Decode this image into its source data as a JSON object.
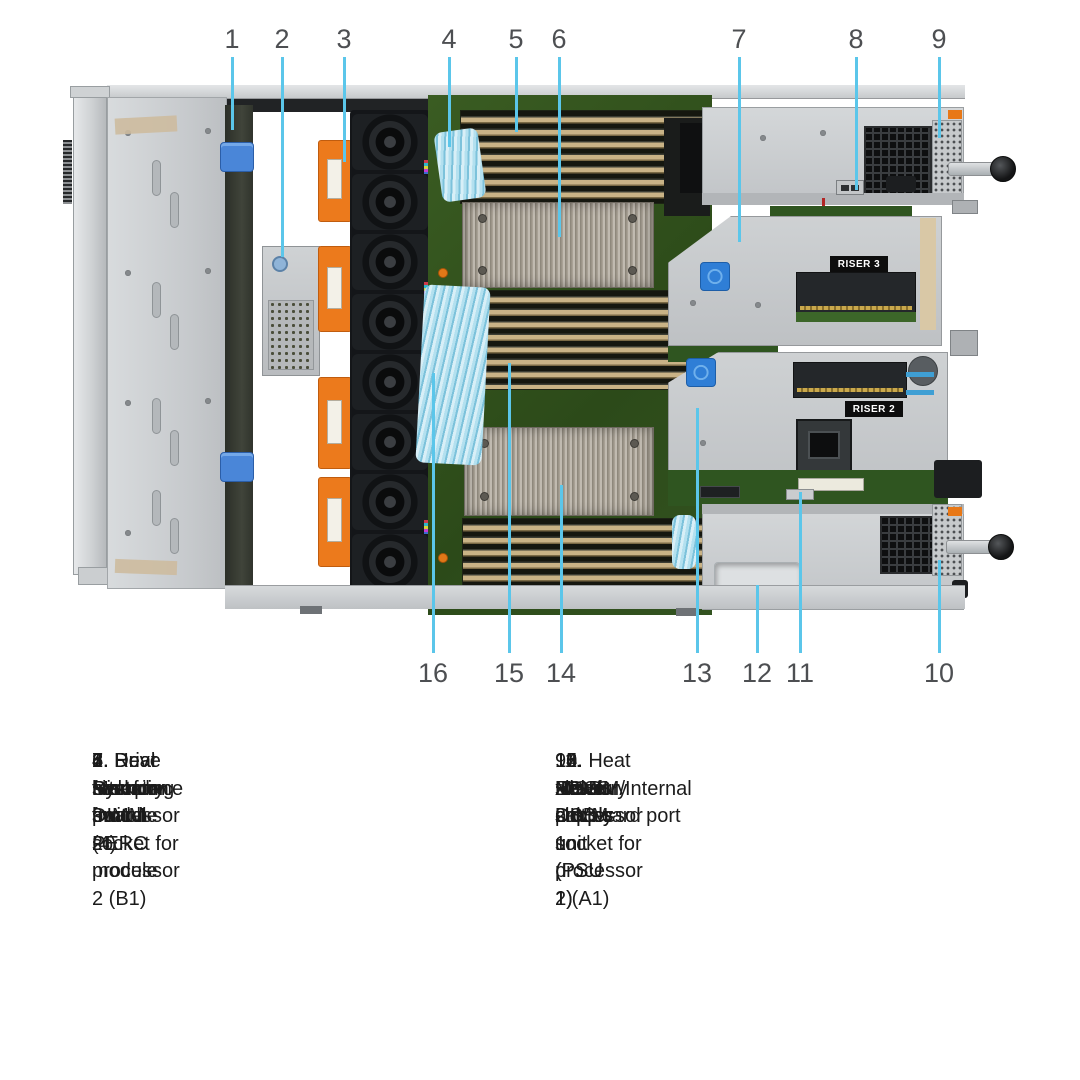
{
  "figure": {
    "description": "Top-down view of server chassis interior with numbered callouts",
    "riser3_label": "RISER 3",
    "riser2_label": "RISER 2"
  },
  "callouts": {
    "line_color": "#5BC6EA",
    "top": [
      {
        "num": "1",
        "x": 232,
        "point_y": 130
      },
      {
        "num": "2",
        "x": 282,
        "point_y": 257
      },
      {
        "num": "3",
        "x": 344,
        "point_y": 162
      },
      {
        "num": "4",
        "x": 449,
        "point_y": 147
      },
      {
        "num": "5",
        "x": 516,
        "point_y": 132
      },
      {
        "num": "6",
        "x": 559,
        "point_y": 237
      },
      {
        "num": "7",
        "x": 739,
        "point_y": 242
      },
      {
        "num": "8",
        "x": 856,
        "point_y": 190
      },
      {
        "num": "9",
        "x": 939,
        "point_y": 138
      }
    ],
    "bottom": [
      {
        "num": "16",
        "x": 433,
        "point_y": 373
      },
      {
        "num": "15",
        "x": 509,
        "point_y": 363
      },
      {
        "num": "14",
        "x": 561,
        "point_y": 485
      },
      {
        "num": "13",
        "x": 697,
        "point_y": 408
      },
      {
        "num": "12",
        "x": 757,
        "point_y": 585
      },
      {
        "num": "11",
        "x": 800,
        "point_y": 492
      },
      {
        "num": "10",
        "x": 939,
        "point_y": 560
      }
    ]
  },
  "legend": {
    "left": [
      {
        "num": "1",
        "label": "Drive backplane"
      },
      {
        "num": "2",
        "label": "Rear mounting front PERC module"
      },
      {
        "num": "3",
        "label": "Dual fan module (4)"
      },
      {
        "num": "4",
        "label": "System board"
      },
      {
        "num": "5",
        "label": "Memory DIMM socket for processor 2 (B1)"
      },
      {
        "num": "6",
        "label": "Heat sink for processor 2"
      },
      {
        "num": "7",
        "label": "Riser 3"
      },
      {
        "num": "8",
        "label": "Intrusion switch"
      }
    ],
    "right": [
      {
        "num": "9",
        "label": "Power supply unit (PSU 2)"
      },
      {
        "num": "10",
        "label": "Power supply unit (PSU 1)"
      },
      {
        "num": "11",
        "label": "IDSDM/Internal USB card port"
      },
      {
        "num": "12",
        "label": "BOSS slot"
      },
      {
        "num": "13",
        "label": "Riser 2"
      },
      {
        "num": "14",
        "label": "Heat sink for processor 1"
      },
      {
        "num": "15",
        "label": "Memory DIMM socket for processor 1 (A1)"
      },
      {
        "num": "16",
        "label": "xGMI cables"
      }
    ]
  }
}
